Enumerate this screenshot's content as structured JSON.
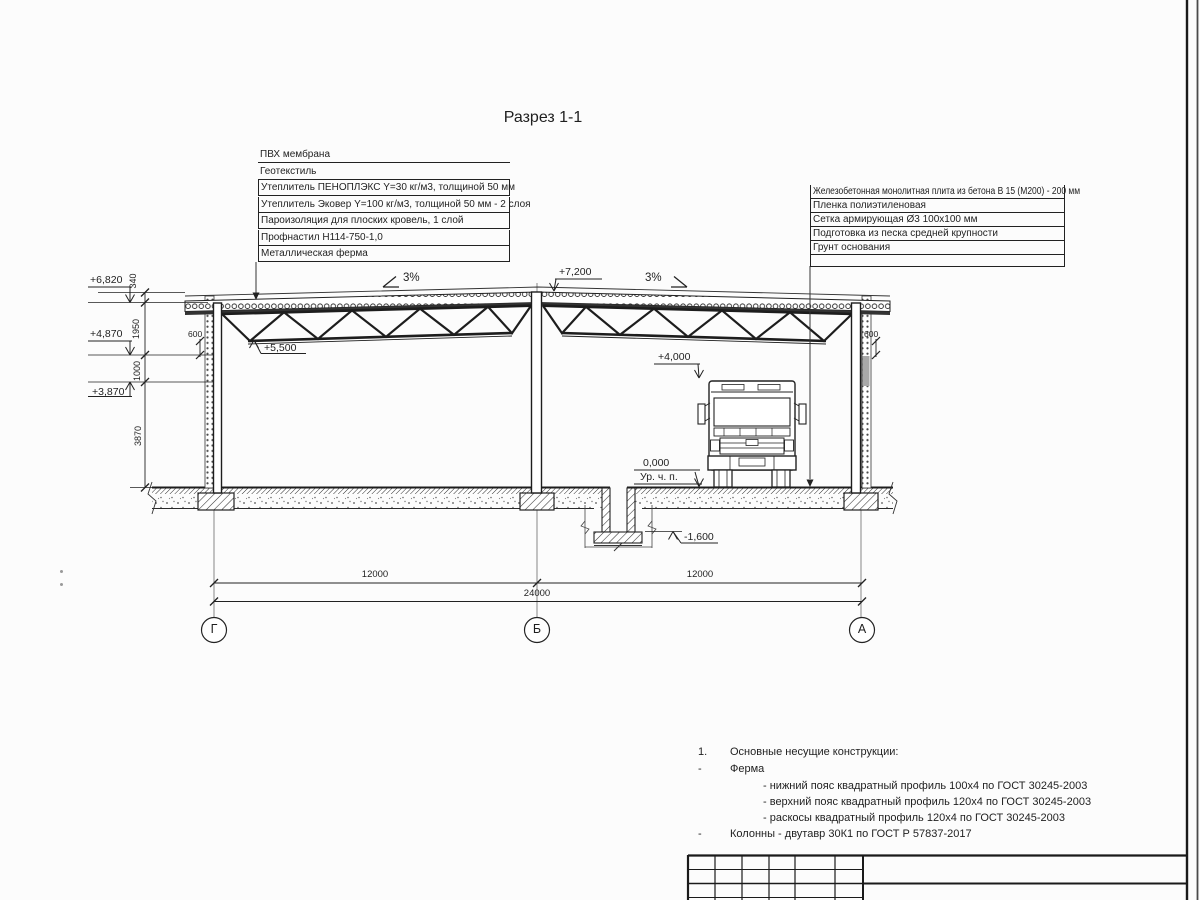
{
  "title": "Разрез 1-1",
  "roof_layers": {
    "rows": [
      "ПВХ мембрана",
      "Геотекстиль",
      "Утеплитель ПЕНОПЛЭКС Y=30 кг/м3, толщиной 50 мм",
      "Утеплитель Эковер Y=100 кг/м3, толщиной 50 мм - 2 слоя",
      "Пароизоляция для плоских кровель, 1 слой",
      "Профнастил Н114-750-1,0",
      "Металлическая ферма"
    ]
  },
  "floor_layers": {
    "rows": [
      "Железобетонная монолитная плита из бетона В 15 (М200) - 200 мм",
      "Пленка полиэтиленовая",
      "Сетка армирующая Ø3 100х100 мм",
      "Подготовка из песка средней крупности",
      "Грунт основания"
    ]
  },
  "elevations": {
    "ridge": "+7,200",
    "eave": "+6,820",
    "truss_bottom": "+5,500",
    "bearing": "+4,870",
    "wall": "+3,870",
    "truck": "+4,000",
    "floor": "0,000",
    "floor_label": "Ур. ч. п.",
    "pit": "-1,600"
  },
  "dims": {
    "v1": "340",
    "v2": "1950",
    "v3": "1000",
    "v4": "3870",
    "span_left": "12000",
    "span_right": "12000",
    "total": "24000",
    "bearing_left": "600",
    "bearing_right": "600"
  },
  "slopes": {
    "left": "3%",
    "right": "3%"
  },
  "axes": {
    "left": "Г",
    "middle": "Б",
    "right": "А"
  },
  "notes": {
    "num": "1.",
    "heading": "Основные несущие конструкции:",
    "dash": "-",
    "truss_label": "Ферма",
    "items": [
      "- нижний пояс квадратный профиль 100х4 по ГОСТ 30245-2003",
      "- верхний пояс квадратный профиль 120х4 по ГОСТ 30245-2003",
      "- раскосы квадратный профиль 120х4 по ГОСТ 30245-2003"
    ],
    "columns_label": "Колонны - двутавр 30К1 по ГОСТ Р 57837-2017"
  }
}
